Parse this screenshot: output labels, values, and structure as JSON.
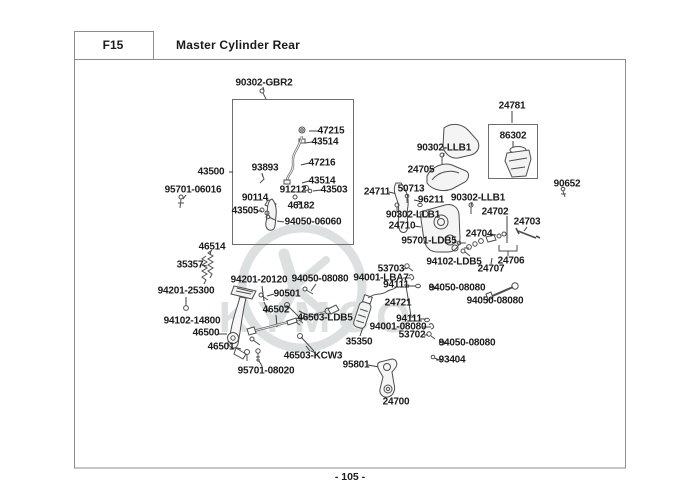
{
  "header": {
    "code": "F15",
    "title": "Master Cylinder Rear"
  },
  "footer": {
    "page_number": "- 105 -"
  },
  "watermark": {
    "brand": "KYMCO"
  },
  "colors": {
    "ink": "#1b1b1b",
    "drawing_line": "#4d4d4d",
    "border": "#8c8c8c",
    "watermark": "#dde0e1"
  },
  "diagram": {
    "labels": [
      {
        "text": "90302-GBR2",
        "x": 264,
        "y": 83
      },
      {
        "text": "43500",
        "x": 211,
        "y": 172
      },
      {
        "text": "95701-06016",
        "x": 193,
        "y": 190
      },
      {
        "text": "47215",
        "x": 331,
        "y": 131
      },
      {
        "text": "43514",
        "x": 325,
        "y": 142
      },
      {
        "text": "47216",
        "x": 322,
        "y": 163
      },
      {
        "text": "43514",
        "x": 322,
        "y": 181
      },
      {
        "text": "43503",
        "x": 334,
        "y": 190
      },
      {
        "text": "93893",
        "x": 265,
        "y": 168
      },
      {
        "text": "91212",
        "x": 293,
        "y": 190
      },
      {
        "text": "90114",
        "x": 255,
        "y": 198
      },
      {
        "text": "43505",
        "x": 245,
        "y": 211
      },
      {
        "text": "46182",
        "x": 301,
        "y": 206
      },
      {
        "text": "94050-06060",
        "x": 313,
        "y": 222
      },
      {
        "text": "46514",
        "x": 212,
        "y": 247
      },
      {
        "text": "35357",
        "x": 190,
        "y": 265
      },
      {
        "text": "94201-25300",
        "x": 186,
        "y": 291
      },
      {
        "text": "94102-14800",
        "x": 192,
        "y": 321
      },
      {
        "text": "46500",
        "x": 206,
        "y": 333
      },
      {
        "text": "46501",
        "x": 221,
        "y": 347
      },
      {
        "text": "95701-08020",
        "x": 266,
        "y": 371
      },
      {
        "text": "94201-20120",
        "x": 259,
        "y": 280
      },
      {
        "text": "90501",
        "x": 287,
        "y": 294
      },
      {
        "text": "46502",
        "x": 276,
        "y": 310
      },
      {
        "text": "46503-LDB5",
        "x": 325,
        "y": 318
      },
      {
        "text": "46503-KCW3",
        "x": 313,
        "y": 356
      },
      {
        "text": "35350",
        "x": 359,
        "y": 342
      },
      {
        "text": "95801",
        "x": 356,
        "y": 365
      },
      {
        "text": "24700",
        "x": 396,
        "y": 402
      },
      {
        "text": "94050-08080",
        "x": 320,
        "y": 279
      },
      {
        "text": "53703",
        "x": 391,
        "y": 269
      },
      {
        "text": "94001-LBA7",
        "x": 381,
        "y": 278
      },
      {
        "text": "94111",
        "x": 396,
        "y": 285
      },
      {
        "text": "24721",
        "x": 398,
        "y": 303
      },
      {
        "text": "94111",
        "x": 409,
        "y": 319
      },
      {
        "text": "94001-08080",
        "x": 398,
        "y": 327
      },
      {
        "text": "53702",
        "x": 412,
        "y": 335
      },
      {
        "text": "94050-08080",
        "x": 457,
        "y": 288
      },
      {
        "text": "94050-08080",
        "x": 495,
        "y": 301
      },
      {
        "text": "94050-08080",
        "x": 467,
        "y": 343
      },
      {
        "text": "93404",
        "x": 452,
        "y": 360
      },
      {
        "text": "24711",
        "x": 377,
        "y": 192
      },
      {
        "text": "50713",
        "x": 411,
        "y": 189
      },
      {
        "text": "96211",
        "x": 431,
        "y": 200
      },
      {
        "text": "90302-LLB1",
        "x": 444,
        "y": 148
      },
      {
        "text": "24705",
        "x": 421,
        "y": 170
      },
      {
        "text": "90302-LLB1",
        "x": 478,
        "y": 198
      },
      {
        "text": "90302-LLB1",
        "x": 413,
        "y": 215
      },
      {
        "text": "24710",
        "x": 402,
        "y": 226
      },
      {
        "text": "95701-LDB5",
        "x": 429,
        "y": 241
      },
      {
        "text": "94102-LDB5",
        "x": 454,
        "y": 262
      },
      {
        "text": "24704",
        "x": 479,
        "y": 234
      },
      {
        "text": "24702",
        "x": 495,
        "y": 212
      },
      {
        "text": "24703",
        "x": 527,
        "y": 222
      },
      {
        "text": "24706",
        "x": 511,
        "y": 261
      },
      {
        "text": "24707",
        "x": 491,
        "y": 269
      },
      {
        "text": "24781",
        "x": 512,
        "y": 106
      },
      {
        "text": "86302",
        "x": 513,
        "y": 136
      },
      {
        "text": "90652",
        "x": 567,
        "y": 184
      }
    ]
  }
}
